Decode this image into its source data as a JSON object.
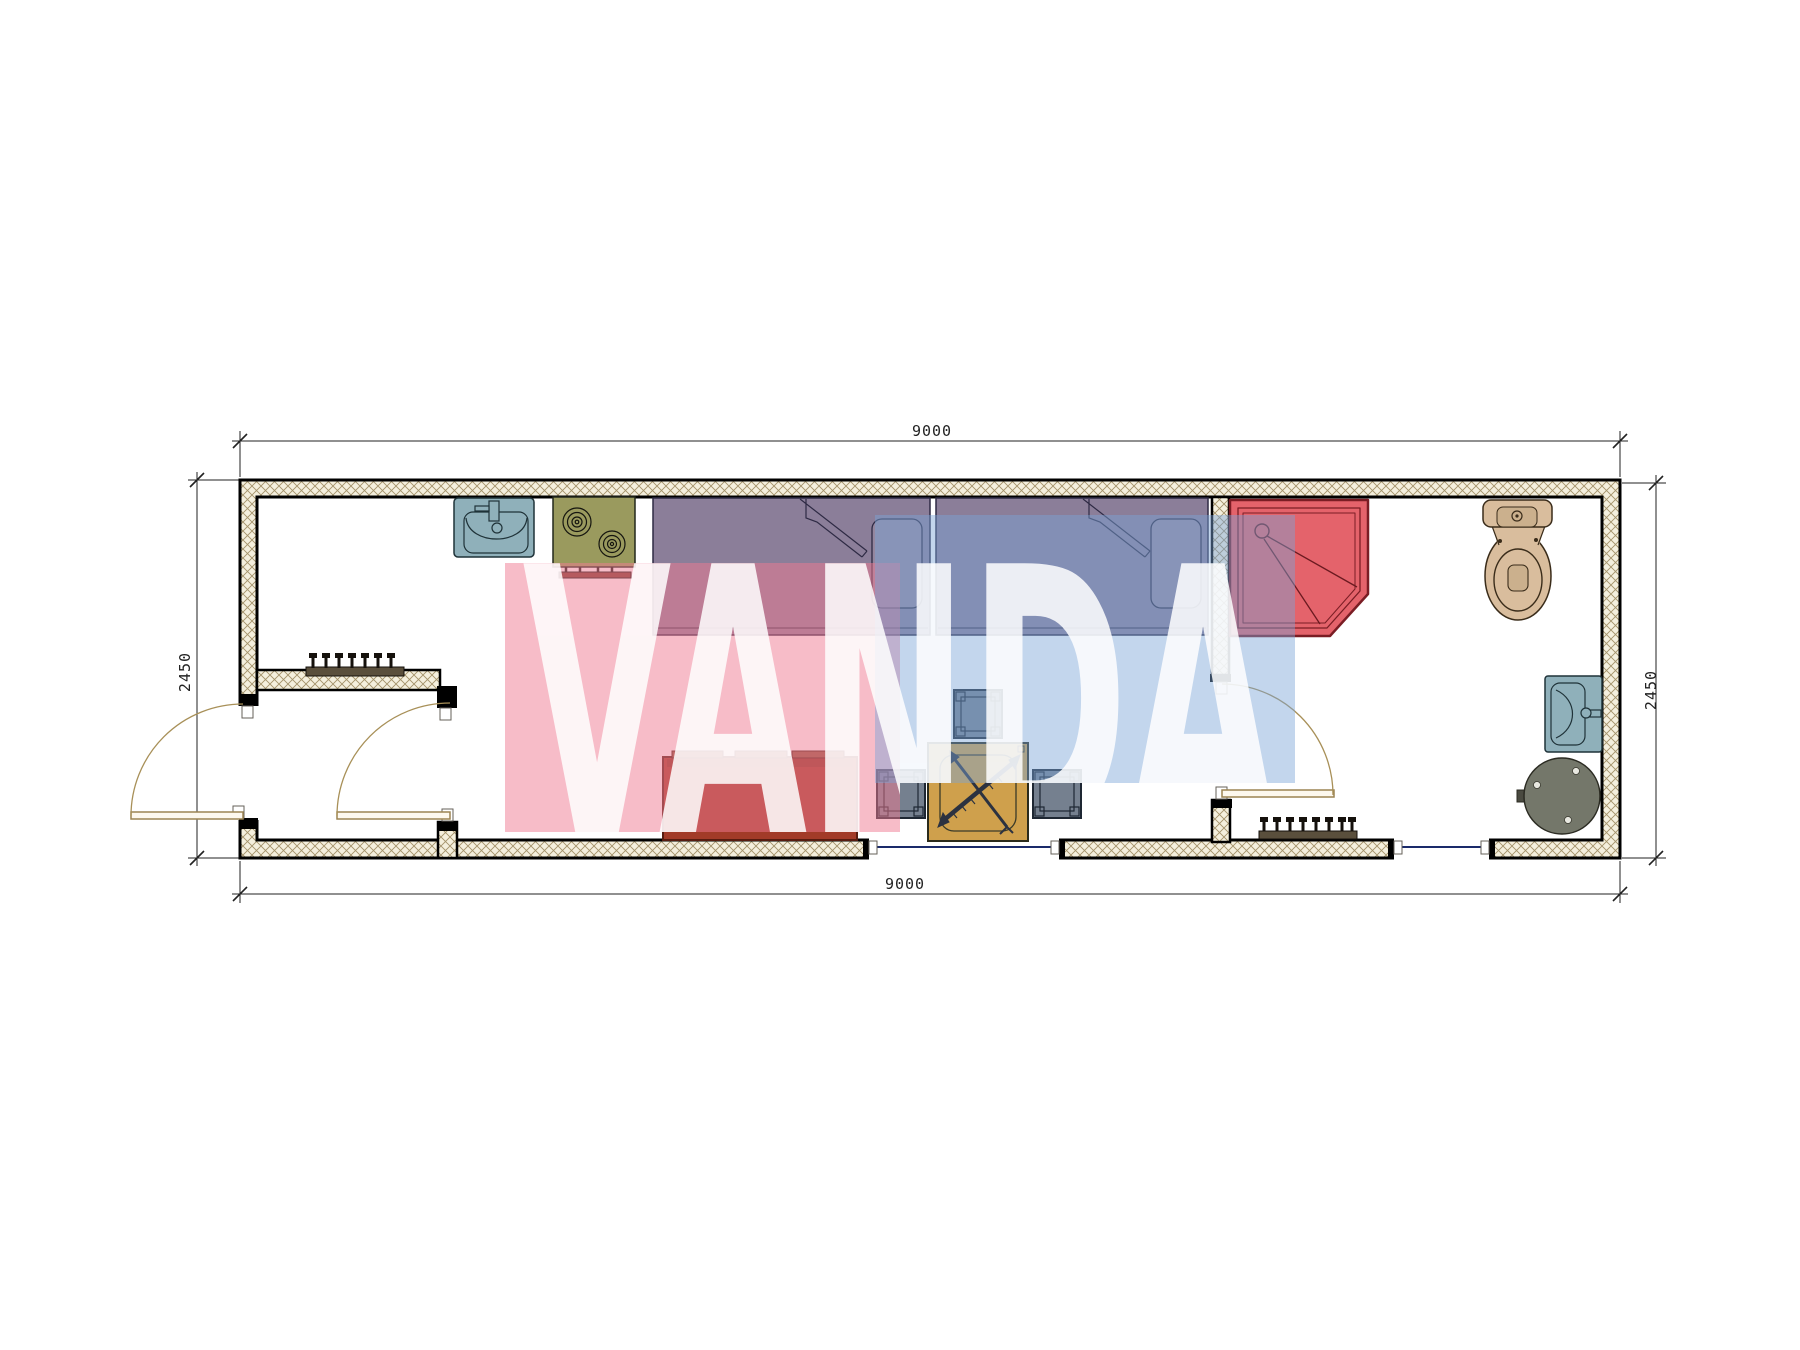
{
  "watermark": {
    "text": "VANDA",
    "pink_color": "#ef7a92",
    "blue_color": "#7ba3d6",
    "letter_color": "#ffffff"
  },
  "dimensions": {
    "top_width": "9000",
    "bottom_width": "9000",
    "left_height": "2450",
    "right_height": "2450"
  },
  "plan": {
    "type": "container-house-floor-plan",
    "fixtures": [
      "entrance-door",
      "vestibule-coat-rack",
      "interior-door",
      "kitchen-sink",
      "stove",
      "bed-1",
      "bed-2",
      "sofa",
      "coffee-table",
      "stool",
      "window",
      "bathroom-door",
      "shower-cabin",
      "toilet",
      "wash-basin",
      "boiler",
      "radiator"
    ],
    "colors": {
      "wall_fill": "#f4efdd",
      "hatch_line": "#a3926a",
      "wall_edge": "#000000",
      "bed": "#8b7e99",
      "pillow": "#94879f",
      "sofa": "#a23b28",
      "sofa_cushion": "#93573f",
      "table": "#cfa04c",
      "stool": "#75808f",
      "shower": "#e4636b",
      "shower_line": "#7a1d24",
      "sink": "#8fb0ba",
      "stove": "#9a9a5e",
      "stove_panel": "#7c3a2c",
      "toilet": "#d9bd9d",
      "boiler": "#74776a",
      "door_leaf": "#9c8452",
      "door_swing": "#a89058",
      "glazing": "#1a2a6a",
      "rack": "#5a4f3c"
    }
  }
}
